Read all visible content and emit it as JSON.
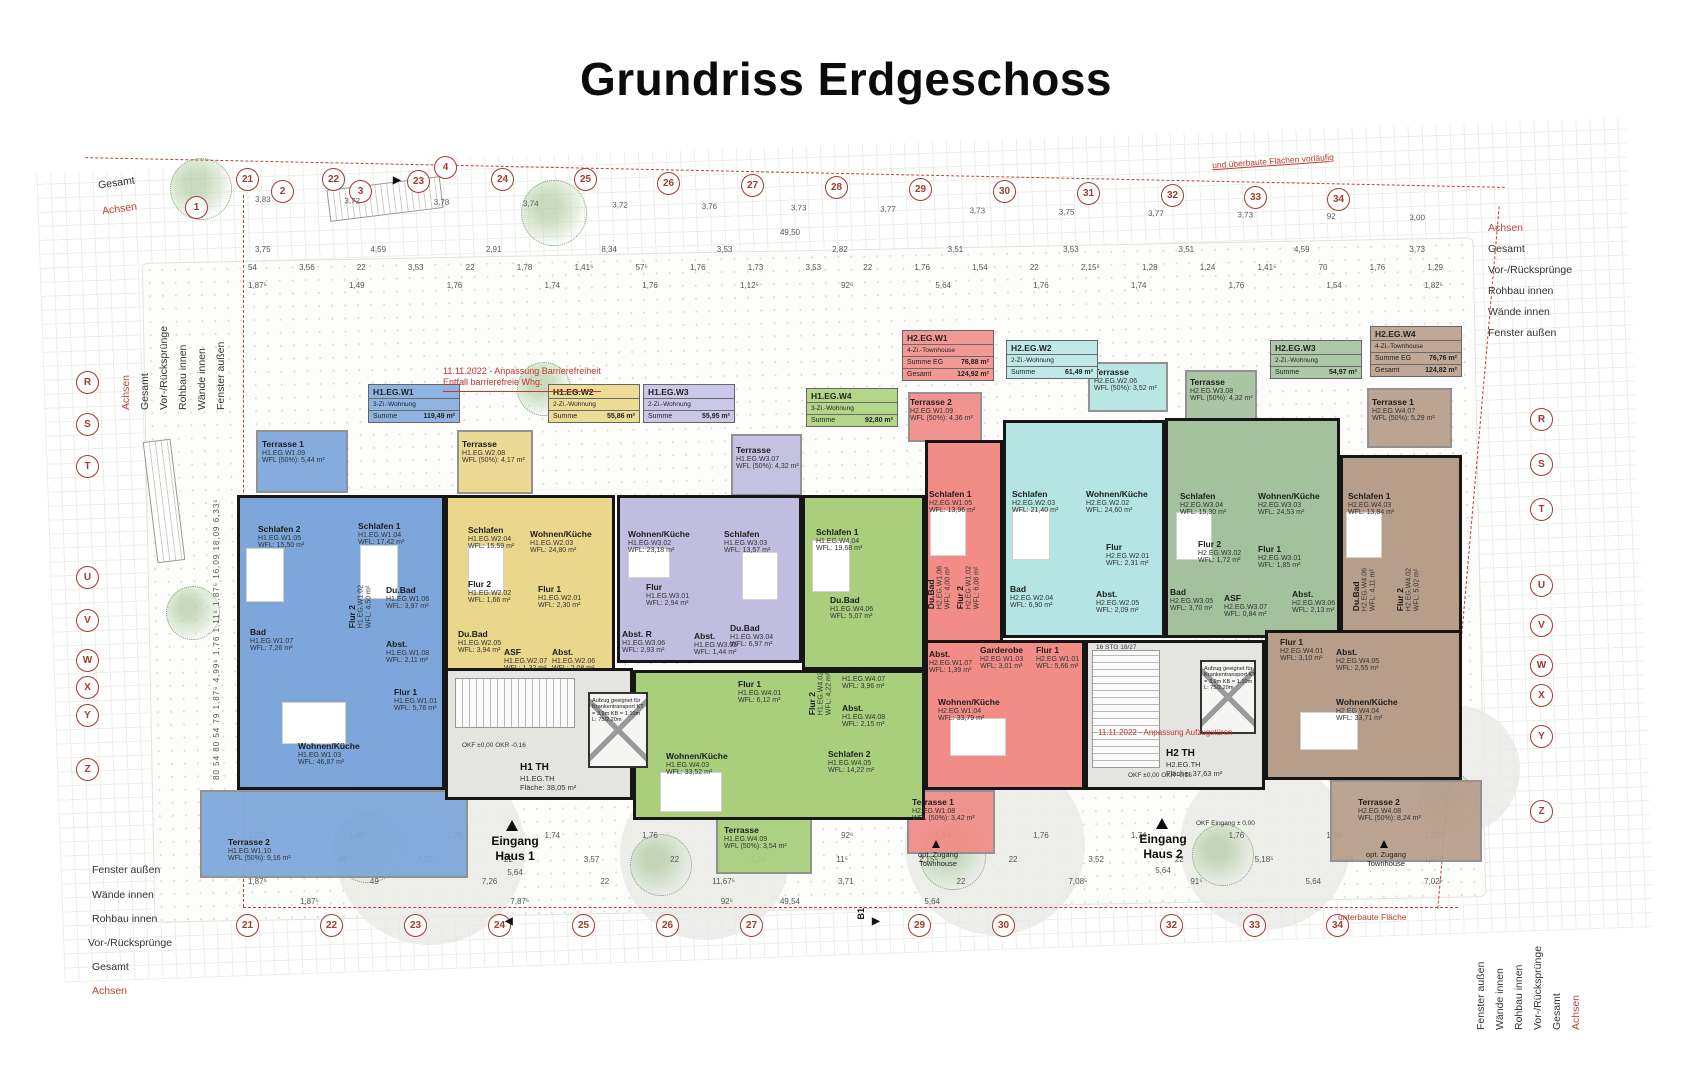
{
  "title": "Grundriss Erdgeschoss",
  "houses": {
    "entrance1": "Eingang\nHaus 1",
    "entrance2": "Eingang\nHaus 2",
    "entrance_dim": "5,64",
    "opt_access": "opt. Zugang\nTownhouse"
  },
  "stairwells": [
    {
      "name": "H1 TH",
      "id": "H1.EG.TH",
      "area": "Fläche: 38,05 m²"
    },
    {
      "name": "H2 TH",
      "id": "H2.EG.TH",
      "area": "Fläche: 37,63 m²"
    }
  ],
  "lift_note": "Aufzug geeignet für Krankentransport KT = 3,9m KB = 1,10m L: 75/2,20m",
  "stair_note": "16 STG 18/27",
  "level_notes": {
    "okf": "OKF ±0,00  OKR -0,16",
    "okf_entrance": "OKF Eingang ± 0,00"
  },
  "red_notes": {
    "barrier": "11.11.2022 - Anpassung Barrierefreiheit",
    "barrier2": "Entfall barrierefreie Whg.",
    "lift_doors": "11.11.2022 - Anpassung Aufzugstüren",
    "preliminary": "und überbaute Flächen vorläufig",
    "underbuilt": "unterbaute Fläche"
  },
  "margin_labels": [
    "Achsen",
    "Gesamt",
    "Vor-/Rücksprünge",
    "Rohbau innen",
    "Wände innen",
    "Fenster außen"
  ],
  "axes": {
    "top": [
      "1",
      "21",
      "2",
      "22",
      "3",
      "23",
      "4",
      "24",
      "25",
      "26",
      "27",
      "28",
      "29",
      "30",
      "31",
      "32",
      "33",
      "34"
    ],
    "bottom": [
      "21",
      "22",
      "23",
      "24",
      "25",
      "26",
      "27",
      "29",
      "30",
      "32",
      "33",
      "34"
    ],
    "left": [
      "R",
      "S",
      "T",
      "U",
      "V",
      "W",
      "X",
      "Y",
      "Z"
    ],
    "right": [
      "R",
      "S",
      "T",
      "U",
      "V",
      "W",
      "X",
      "Y",
      "Z"
    ],
    "section_marker": "B1"
  },
  "dims": {
    "top_axis_spacing": [
      "3,83",
      "3,72",
      "3,78",
      "3,74",
      "3,72",
      "3,76",
      "3,73",
      "3,77",
      "3,73",
      "3,75",
      "3,77",
      "3,73",
      "92",
      "3,00"
    ],
    "top_total": "49,50",
    "top_chain1": [
      "3,75",
      "4,59",
      "2,91",
      "8,34",
      "3,53",
      "2,82",
      "3,51",
      "3,53",
      "3,51",
      "4,59",
      "3,73"
    ],
    "top_chain2": [
      "54",
      "3,56",
      "22",
      "3,53",
      "22",
      "1,78",
      "1,41⁵",
      "57⁵",
      "1,76",
      "1,73",
      "3,53",
      "22",
      "1,76",
      "1,54",
      "22",
      "2,15⁵",
      "1,28",
      "1,24",
      "1,41⁵",
      "70",
      "1,76",
      "1,29"
    ],
    "pair": {
      "a": "1,76",
      "b": "2,61"
    },
    "bottom_chain1": [
      "1,87⁵",
      "1,49",
      "1,76",
      "1,74",
      "1,76",
      "1,12⁵",
      "92⁶",
      "5,64",
      "1,76",
      "1,74",
      "1,76",
      "1,54",
      "1,82⁵"
    ],
    "bottom_chain2": [
      "1,87⁵",
      "49",
      "7,26",
      "22",
      "3,57",
      "22",
      "1,24",
      "11⁵",
      "2,15⁵",
      "22",
      "3,52",
      "22",
      "5,18⁵",
      "18",
      "1,87⁵"
    ],
    "bottom_chain3": [
      "1,87⁵",
      "49",
      "7,26",
      "22",
      "11,67⁵",
      "3,71",
      "22",
      "7,08⁵",
      "91⁵",
      "5,64",
      "7,02⁵"
    ],
    "bottom_chain4": [
      "1,87⁵",
      "7,87⁵",
      "92⁵",
      "5,64"
    ],
    "bottom_total": "49,54",
    "left_col": [
      "80",
      "54",
      "80",
      "54",
      "79",
      "1,87⁵",
      "4,99⁵",
      "1,76",
      "1,11⁵",
      "1,87⁵",
      "16,09",
      "18,09",
      "6,33⁵"
    ],
    "right_col": [
      "80",
      "2,23⁵",
      "1,87⁵",
      "1,33⁵",
      "16,09",
      "6,40",
      "4,15",
      "1,62",
      "5,41⁵",
      "2,68",
      "1,82⁵"
    ]
  },
  "units": [
    {
      "id": "H1.EG.W1",
      "type": "3-Zi.-Wohnung",
      "sum_label": "Summe",
      "sum": "119,49 m²",
      "color": "#7DA7DA",
      "card_color": "#8FB4E2",
      "rooms": [
        {
          "name": "Terrasse 1",
          "id": "H1.EG.W1.09",
          "wfl": "WFL (50%): 5,44 m²"
        },
        {
          "name": "Schlafen 2",
          "id": "H1.EG.W1.05",
          "wfl": "WFL: 15,50 m²"
        },
        {
          "name": "Schlafen 1",
          "id": "H1.EG.W1.04",
          "wfl": "WFL: 17,42 m²"
        },
        {
          "name": "Bad",
          "id": "H1.EG.W1.07",
          "wfl": "WFL: 7,26 m²"
        },
        {
          "name": "Flur 2",
          "id": "H1.EG.W1.02",
          "wfl": "WFL: 4,50 m²"
        },
        {
          "name": "Du.Bad",
          "id": "H1.EG.W1.06",
          "wfl": "WFL: 3,97 m²"
        },
        {
          "name": "Abst.",
          "id": "H1.EG.W1.08",
          "wfl": "WFL: 2,11 m²"
        },
        {
          "name": "Flur 1",
          "id": "H1.EG.W1.01",
          "wfl": "WFL: 5,76 m²"
        },
        {
          "name": "Wohnen/Küche",
          "id": "H1.EG.W1.03",
          "wfl": "WFL: 46,87 m²"
        },
        {
          "name": "Terrasse 2",
          "id": "H1.EG.W1.10",
          "wfl": "WFL (50%): 9,16 m²"
        }
      ]
    },
    {
      "id": "H1.EG.W2",
      "type": "2-Zi.-Wohnung",
      "sum_label": "Summe",
      "sum": "55,86 m²",
      "color": "#EBD78C",
      "card_color": "#EDDC96",
      "rooms": [
        {
          "name": "Terrasse",
          "id": "H1.EG.W2.08",
          "wfl": "WFL (50%): 4,17 m²"
        },
        {
          "name": "Schlafen",
          "id": "H1.EG.W2.04",
          "wfl": "WFL: 15,59 m²"
        },
        {
          "name": "Flur 2",
          "id": "H1.EG.W2.02",
          "wfl": "WFL: 1,66 m²"
        },
        {
          "name": "Wohnen/Küche",
          "id": "H1.EG.W2.03",
          "wfl": "WFL: 24,80 m²"
        },
        {
          "name": "Flur 1",
          "id": "H1.EG.W2.01",
          "wfl": "WFL: 2,30 m²"
        },
        {
          "name": "Du.Bad",
          "id": "H1.EG.W2.05",
          "wfl": "WFL: 3,94 m²"
        },
        {
          "name": "ASF",
          "id": "H1.EG.W2.07",
          "wfl": "WFL: 1,32 m²"
        },
        {
          "name": "Abst.",
          "id": "H1.EG.W2.06",
          "wfl": "WFL: 2,08 m²"
        }
      ]
    },
    {
      "id": "H1.EG.W3",
      "type": "2-Zi.-Wohnung",
      "sum_label": "Summe",
      "sum": "55,95 m²",
      "color": "#C1BDE0",
      "card_color": "#CBC7E8",
      "rooms": [
        {
          "name": "Terrasse",
          "id": "H1.EG.W3.07",
          "wfl": "WFL (50%): 4,32 m²"
        },
        {
          "name": "Wohnen/Küche",
          "id": "H1.EG.W3.02",
          "wfl": "WFL: 23,18 m²"
        },
        {
          "name": "Schlafen",
          "id": "H1.EG.W3.03",
          "wfl": "WFL: 13,57 m²"
        },
        {
          "name": "Flur",
          "id": "H1.EG.W3.01",
          "wfl": "WFL: 2,94 m²"
        },
        {
          "name": "Du.Bad",
          "id": "H1.EG.W3.04",
          "wfl": "WFL: 6,97 m²"
        },
        {
          "name": "Abst. R",
          "id": "H1.EG.W3.06",
          "wfl": "WFL: 2,93 m²"
        },
        {
          "name": "Abst.",
          "id": "H1.EG.W3.05",
          "wfl": "WFL: 1,44 m²"
        }
      ]
    },
    {
      "id": "H1.EG.W4",
      "type": "3-Zi.-Wohnung",
      "sum_label": "Summe",
      "sum": "92,80 m²",
      "color": "#A9CF7C",
      "card_color": "#B4D68A",
      "rooms": [
        {
          "name": "Schlafen 1",
          "id": "H1.EG.W4.04",
          "wfl": "WFL: 19,68 m²"
        },
        {
          "name": "Du.Bad",
          "id": "H1.EG.W4.06",
          "wfl": "WFL: 5,07 m²"
        },
        {
          "name": "Flur 2",
          "id": "H1.EG.W4.02",
          "wfl": "WFL: 4,22 m²"
        },
        {
          "name": "Du.Bad",
          "id": "H1.EG.W4.07",
          "wfl": "WFL: 3,96 m²"
        },
        {
          "name": "Abst.",
          "id": "H1.EG.W4.08",
          "wfl": "WFL: 2,15 m²"
        },
        {
          "name": "Schlafen 2",
          "id": "H1.EG.W4.05",
          "wfl": "WFL: 14,22 m²"
        },
        {
          "name": "Flur 1",
          "id": "H1.EG.W4.01",
          "wfl": "WFL: 6,12 m²"
        },
        {
          "name": "Wohnen/Küche",
          "id": "H1.EG.W4.03",
          "wfl": "WFL: 33,52 m²"
        },
        {
          "name": "Terrasse",
          "id": "H1.EG.W4.09",
          "wfl": "WFL (50%): 3,54 m²"
        }
      ]
    },
    {
      "id": "H2.EG.W1",
      "type": "4-Zi.-Townhouse",
      "sum_label": "Summe EG",
      "sum": "76,88 m²",
      "sum2_label": "Gesamt",
      "sum2": "124,92 m²",
      "color": "#F18C87",
      "card_color": "#F29993",
      "rooms": [
        {
          "name": "Terrasse 2",
          "id": "H2.EG.W1.09",
          "wfl": "WFL (50%): 4,36 m²"
        },
        {
          "name": "Schlafen 1",
          "id": "H2.EG.W1.05",
          "wfl": "WFL: 13,96 m²"
        },
        {
          "name": "Du.Bad",
          "id": "H2.EG.W1.06",
          "wfl": "WFL: 4,00 m²"
        },
        {
          "name": "Flur 2",
          "id": "H2.EG.W1.02",
          "wfl": "WFL: 6,08 m²"
        },
        {
          "name": "Abst.",
          "id": "H2.EG.W1.07",
          "wfl": "WFL: 1,39 m²"
        },
        {
          "name": "Garderobe",
          "id": "H2.EG.W1.03",
          "wfl": "WFL: 3,01 m²"
        },
        {
          "name": "Flur 1",
          "id": "H2.EG.W1.01",
          "wfl": "WFL: 5,66 m²"
        },
        {
          "name": "Wohnen/Küche",
          "id": "H2.EG.W1.04",
          "wfl": "WFL: 33,79 m²"
        },
        {
          "name": "Terrasse 1",
          "id": "H2.EG.W1.08",
          "wfl": "WFL (50%): 3,42 m²"
        }
      ]
    },
    {
      "id": "H2.EG.W2",
      "type": "2-Zi.-Wohnung",
      "sum_label": "Summe",
      "sum": "61,49 m²",
      "color": "#B4E5E2",
      "card_color": "#BFE9E7",
      "rooms": [
        {
          "name": "Terrasse",
          "id": "H2.EG.W2.06",
          "wfl": "WFL (50%): 3,52 m²"
        },
        {
          "name": "Schlafen",
          "id": "H2.EG.W2.03",
          "wfl": "WFL: 21,40 m²"
        },
        {
          "name": "Wohnen/Küche",
          "id": "H2.EG.W2.02",
          "wfl": "WFL: 24,60 m²"
        },
        {
          "name": "Flur",
          "id": "H2.EG.W2.01",
          "wfl": "WFL: 2,31 m²"
        },
        {
          "name": "Bad",
          "id": "H2.EG.W2.04",
          "wfl": "WFL: 6,90 m²"
        },
        {
          "name": "Abst.",
          "id": "H2.EG.W2.05",
          "wfl": "WFL: 2,09 m²"
        }
      ]
    },
    {
      "id": "H2.EG.W3",
      "type": "2-Zi.-Wohnung",
      "sum_label": "Summe",
      "sum": "54,97 m²",
      "color": "#A3C19D",
      "card_color": "#ACC8A6",
      "rooms": [
        {
          "name": "Terrasse",
          "id": "H2.EG.W3.08",
          "wfl": "WFL (50%): 4,32 m²"
        },
        {
          "name": "Schlafen",
          "id": "H2.EG.W3.04",
          "wfl": "WFL: 15,30 m²"
        },
        {
          "name": "Flur 2",
          "id": "H2.EG.W3.02",
          "wfl": "WFL: 1,72 m²"
        },
        {
          "name": "Wohnen/Küche",
          "id": "H2.EG.W3.03",
          "wfl": "WFL: 24,53 m²"
        },
        {
          "name": "Flur 1",
          "id": "H2.EG.W3.01",
          "wfl": "WFL: 1,85 m²"
        },
        {
          "name": "Bad",
          "id": "H2.EG.W3.05",
          "wfl": "WFL: 3,70 m²"
        },
        {
          "name": "ASF",
          "id": "H2.EG.W3.07",
          "wfl": "WFL: 0,84 m²"
        },
        {
          "name": "Abst.",
          "id": "H2.EG.W3.06",
          "wfl": "WFL: 2,13 m²"
        }
      ]
    },
    {
      "id": "H2.EG.W4",
      "type": "4-Zi.-Townhouse",
      "sum_label": "Summe EG",
      "sum": "76,76 m²",
      "sum2_label": "Gesamt",
      "sum2": "124,82 m²",
      "color": "#B79E8B",
      "card_color": "#BFA896",
      "rooms": [
        {
          "name": "Terrasse 1",
          "id": "H2.EG.W4.07",
          "wfl": "WFL (50%): 5,29 m²"
        },
        {
          "name": "Schlafen 1",
          "id": "H2.EG.W4.03",
          "wfl": "WFL: 13,84 m²"
        },
        {
          "name": "Du.Bad",
          "id": "H2.EG.W4.06",
          "wfl": "WFL: 4,11 m²"
        },
        {
          "name": "Flur 2",
          "id": "H2.EG.W4.02",
          "wfl": "WFL: 5,02 m²"
        },
        {
          "name": "Flur 1",
          "id": "H2.EG.W4.01",
          "wfl": "WFL: 3,10 m²"
        },
        {
          "name": "Abst.",
          "id": "H2.EG.W4.05",
          "wfl": "WFL: 2,55 m²"
        },
        {
          "name": "Wohnen/Küche",
          "id": "H2.EG.W4.04",
          "wfl": "WFL: 33,71 m²"
        },
        {
          "name": "Terrasse 2",
          "id": "H2.EG.W4.08",
          "wfl": "WFL (50%): 8,24 m²"
        }
      ]
    }
  ]
}
